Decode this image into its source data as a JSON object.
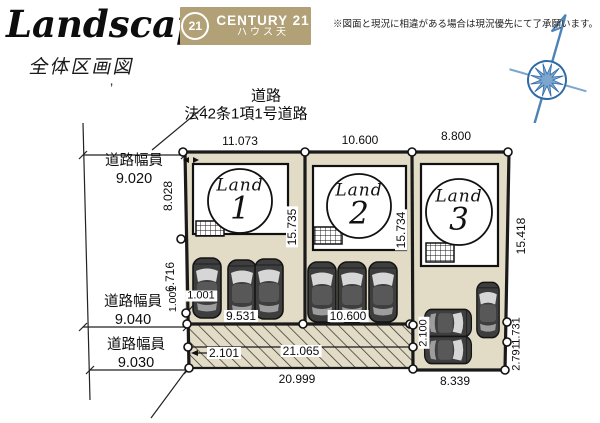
{
  "header": {
    "brand": "Landscape",
    "subtitle": "全体区画図",
    "tick": "’",
    "c21_badge": {
      "circle_text": "21",
      "brand": "CENTURY 21",
      "branch": "ハウス天"
    },
    "disclaimer": "※図面と現況に相違がある場合は現況優先にて了承願います。"
  },
  "plan": {
    "road": {
      "title": "道路",
      "law": "法42条1項1号道路"
    },
    "road_width_label": "道路幅員",
    "road_widths": {
      "top": "9.020",
      "middle": "9.040",
      "bottom": "9.030"
    },
    "top_dims": {
      "lot1": "11.073",
      "lot2": "10.600",
      "lot3": "8.800"
    },
    "left_dims": {
      "d1": "8.028",
      "d2": "6.716",
      "d3": "1.001",
      "d4": "1.001"
    },
    "divider_dims": {
      "lot1_2": "15.735",
      "lot2_3": "15.734"
    },
    "right_dims": {
      "d1": "15.418",
      "d2": "1.731",
      "d3": "2.791"
    },
    "parking_dims": {
      "lot1": "9.531",
      "lot2": "10.600"
    },
    "hatch_dims": {
      "height_left": "2.101",
      "length": "21.065",
      "total": "20.999",
      "height_right": "2.100"
    },
    "lot3_dims": {
      "bottom": "8.339"
    },
    "lots": [
      {
        "label": "Land",
        "number": "1"
      },
      {
        "label": "Land",
        "number": "2"
      },
      {
        "label": "Land",
        "number": "3"
      }
    ]
  },
  "colors": {
    "lot_fill": "#e2dbc6",
    "c21_gold": "#b2a176",
    "line": "#1a1a1a",
    "compass_blue": "#4d83b8"
  }
}
